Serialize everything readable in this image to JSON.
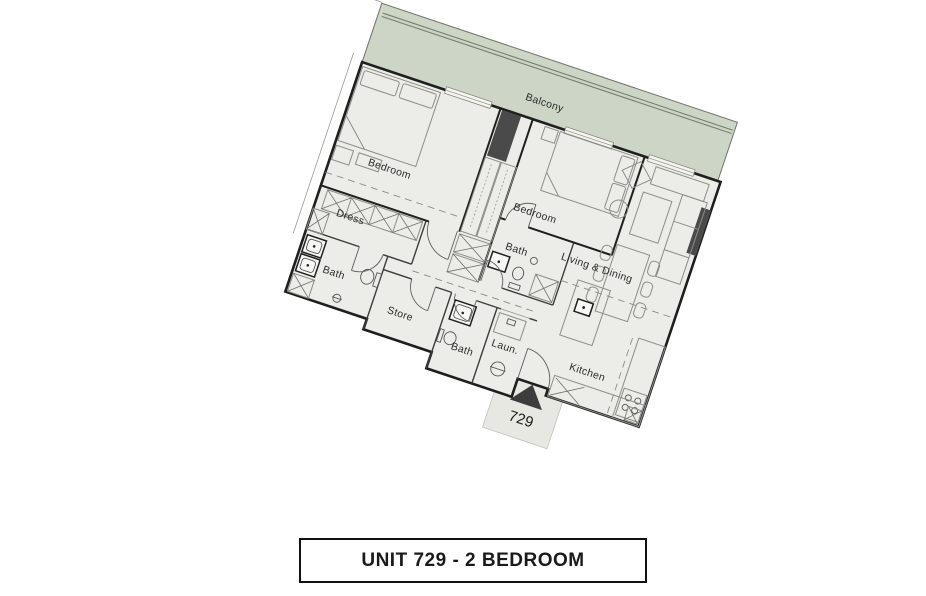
{
  "title": "UNIT 729 - 2 BEDROOM",
  "unit_number": "729",
  "rooms": {
    "balcony": "Balcony",
    "bedroom1": "Bedroom",
    "bedroom2": "Bedroom",
    "dress": "Dress",
    "bath1": "Bath",
    "bath2": "Bath",
    "bath3": "Bath",
    "store": "Store",
    "laundry": "Laun.",
    "living_dining": "Living & Dining",
    "kitchen": "Kitchen"
  },
  "colors": {
    "balcony": "#ccd5c6",
    "floor": "#ecede8",
    "wall": "#1f1f1f",
    "column": "#4a4a4a",
    "entry_pad": "#e7e8e2"
  }
}
